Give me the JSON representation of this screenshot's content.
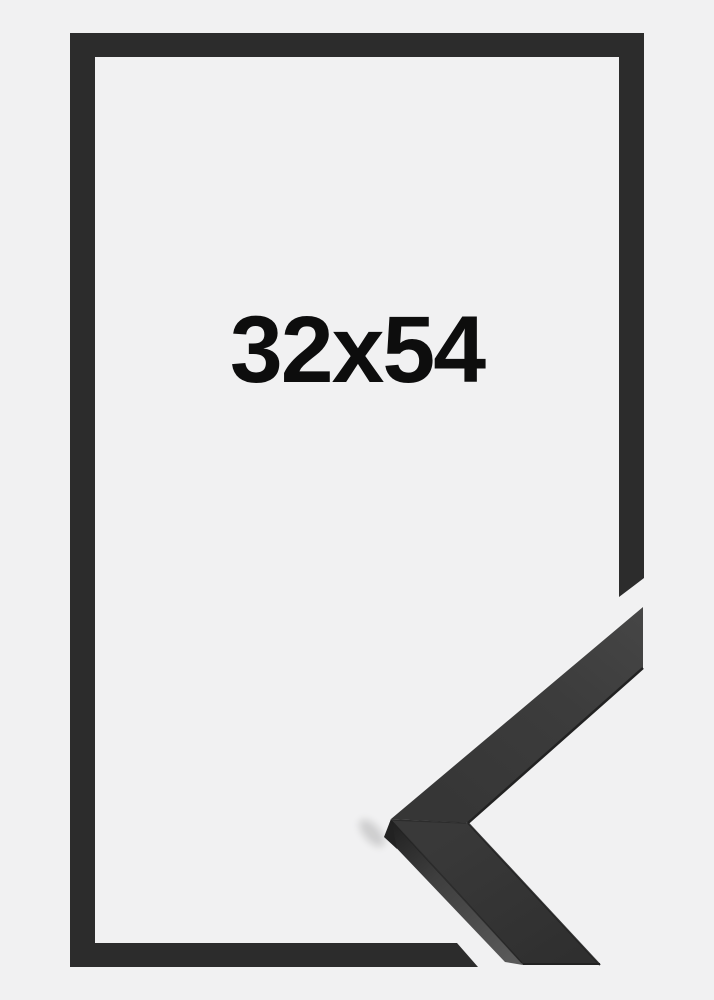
{
  "product": {
    "size_label": "32x54"
  },
  "colors": {
    "background": "#f1f1f2",
    "frame": "#2c2c2c",
    "label": "#0d0d0d",
    "profile_face_upper": "#3f3f3f",
    "profile_face_lower": "#333333",
    "profile_side": "#4f4f4f",
    "profile_edge": "#222222"
  }
}
